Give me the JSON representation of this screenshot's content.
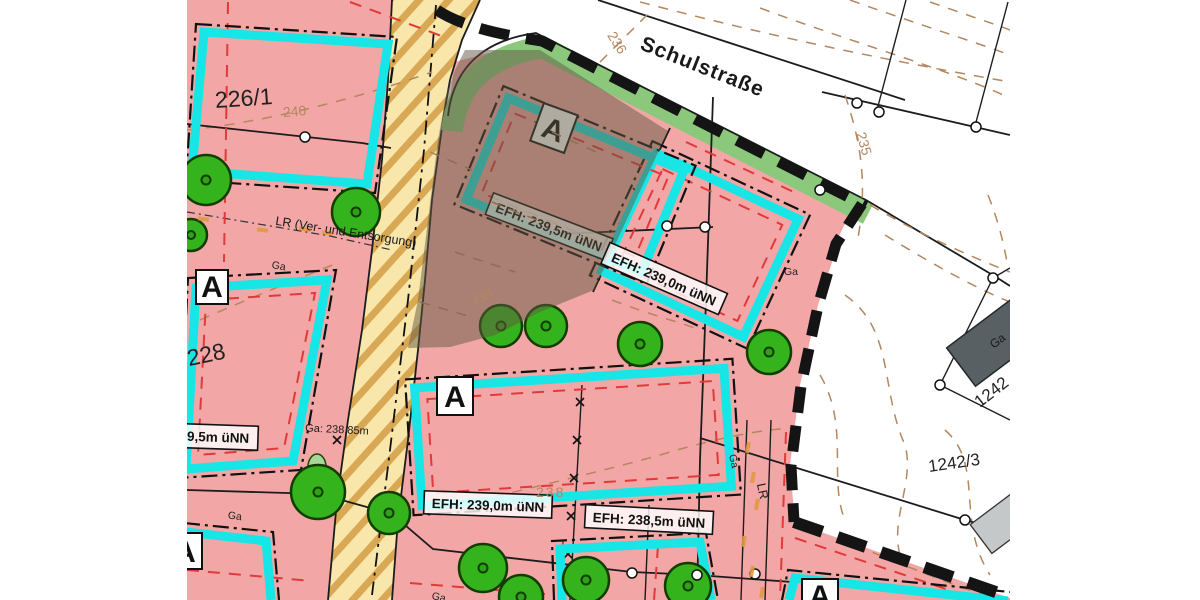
{
  "street": {
    "name": "Schulstraße"
  },
  "parcels": {
    "p226_1": "226/1",
    "p228": "228",
    "p1242_3": "1242/3",
    "p1242": "1242"
  },
  "contours": {
    "c235": "235",
    "c236": "236",
    "c238": "238",
    "c239": "239",
    "c240": "240"
  },
  "annotations": {
    "lr_line": "LR (Ver- und Entsorgung)",
    "lr": "LR",
    "ga": "Ga",
    "ga_height": "Ga: 238,85m",
    "efh_239_5": "EFH: 239,5m üNN",
    "efh_239_0": "EFH: 239,0m üNN",
    "efh_238_5": "EFH: 238,5m üNN",
    "zone_a": "A"
  },
  "colors": {
    "plot_pink": "#f3a6a6",
    "building_window_cyan": "#18e6e6",
    "street_green": "#8cc87c",
    "road_fill": "#f8e6ab",
    "road_hatch": "#d9a854",
    "tree_green": "#35b31c",
    "contour_tan": "#b3875f",
    "building_gray": "#596063",
    "boundary_black": "#141414",
    "limit_red": "#e03a3a",
    "overlay_brown": "rgba(97,87,66,0.5)"
  }
}
